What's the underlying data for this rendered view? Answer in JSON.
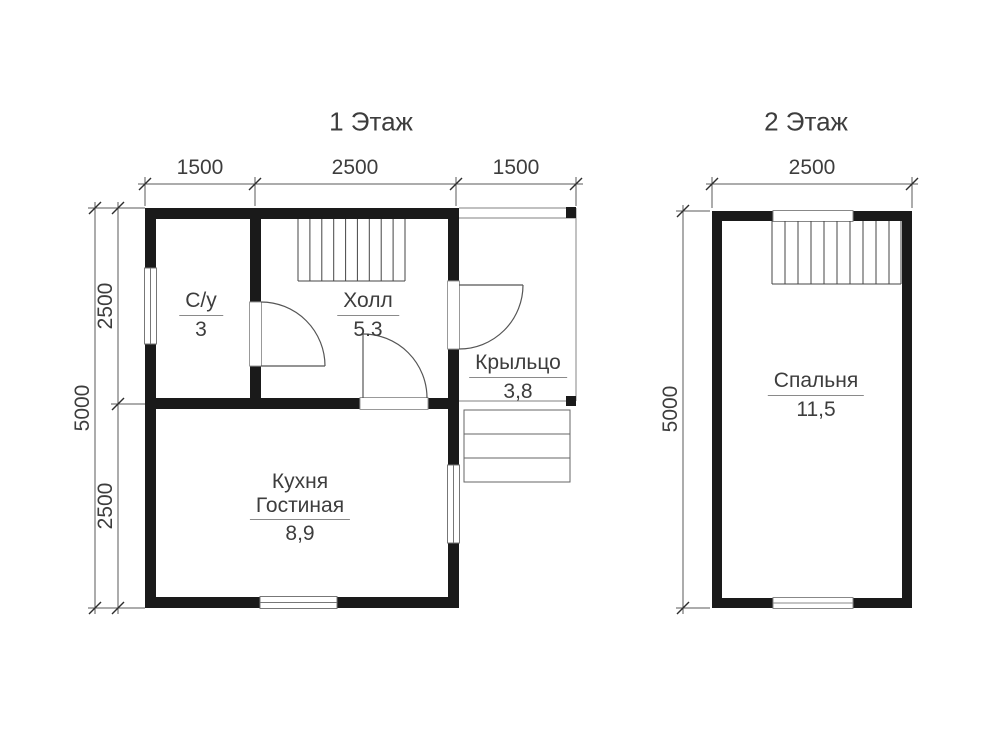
{
  "floor1": {
    "title": "1 Этаж",
    "dim_top": [
      "1500",
      "2500",
      "1500"
    ],
    "dim_left_inner": [
      "2500",
      "2500"
    ],
    "dim_left_outer": "5000",
    "rooms": {
      "bathroom": {
        "name": "С/у",
        "area": "3"
      },
      "hall": {
        "name": "Холл",
        "area": "5.3"
      },
      "porch": {
        "name": "Крыльцо",
        "area": "3,8"
      },
      "kitchen": {
        "name_line1": "Кухня",
        "name_line2": "Гостиная",
        "area": "8,9"
      }
    }
  },
  "floor2": {
    "title": "2 Этаж",
    "dim_top": "2500",
    "dim_left": "5000",
    "rooms": {
      "bedroom": {
        "name": "Спальня",
        "area": "11,5"
      }
    }
  },
  "colors": {
    "wall": "#1a1a1a",
    "text": "#3d3d3d",
    "dim_line": "#5a5a5a",
    "thin_line": "#555555",
    "porch_line": "#999999"
  }
}
